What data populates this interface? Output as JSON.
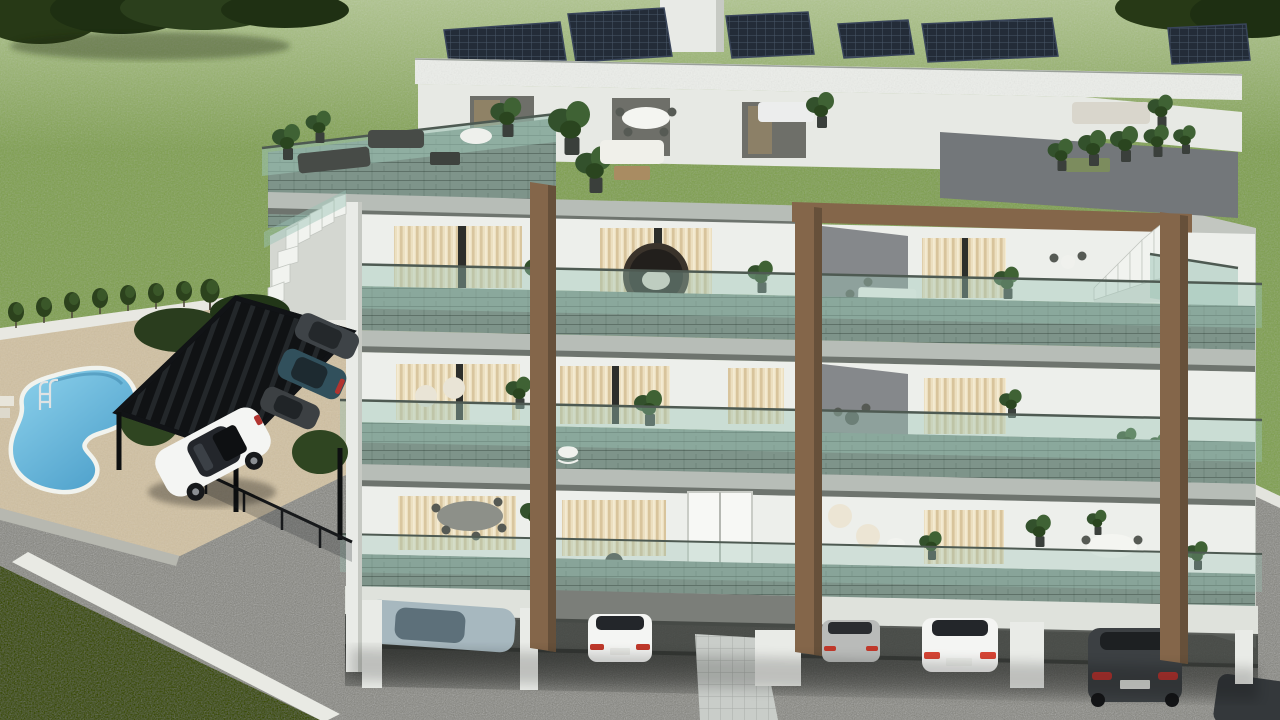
{
  "scene": {
    "type": "3D architectural exterior rendering, aerial view",
    "subject": "Modern terraced apartment residence at dusk with warm interior lighting",
    "labels": {
      "lawn": "large green lawn surrounding the property",
      "trees_left": "tree cluster top left",
      "trees_right": "tree cluster top right",
      "gravel": "gray gravel driveway and parking court",
      "pool_area": "paved pool deck with planting along white garden wall",
      "pool": "freeform kidney-shaped swimming pool",
      "pool_ladder": "chrome pool ladder",
      "pergola": "black slatted pergola carport",
      "carport_cars": "cars parked under pergola carport",
      "white_car": "white car parked on gravel court",
      "building": "four-level modern apartment building",
      "roof_solar": "rooftop solar panel arrays",
      "roof_terrace": "roof terrace with outdoor lounge furniture and planters",
      "floor2_balcony": "second floor balconies with glass balustrade",
      "floor1_balcony": "first floor balconies with glass balustrade",
      "ground_terrace": "ground floor terraces",
      "parking_level": "open parking level under the building",
      "stairs_left": "external staircase on left side",
      "stairs_right": "external staircase to roof terrace on right side",
      "walkway": "tiled walkway from parking court",
      "curb": "white curb between gravel court and lawn",
      "fence": "dark framed glass fence by pool deck"
    }
  },
  "palette": {
    "grass_base": "#87a55c",
    "grass_light_top": "#b2c68c",
    "grass_dark_corner": "#42511f",
    "tree_foliage": "#273916",
    "gravel_base": "#989893",
    "gravel_dark": "#6d6d68",
    "pool_deck": "#d3c4a7",
    "pool_water_light": "#8ed2ec",
    "pool_water_deep": "#4c9fca",
    "pool_rim": "#f1f3ee",
    "pergola_black": "#111316",
    "bronze_column": "#84664a",
    "bronze_shadow": "#66503a",
    "wall_white": "#edefeb",
    "wall_gray": "#85888b",
    "wall_gray_dark": "#73777a",
    "fascia_stone": "#b7bdb7",
    "soffit_dark": "#6e746e",
    "glass_green": "#9cc3b5",
    "paver_surface": "#7e948a",
    "curtain_cream": "#ecdfc0",
    "curtain_glow": "#f6e6bb",
    "interior_dark": "#6e6f69",
    "solar_panel": "#232c38",
    "car_white": "#f4f5f3",
    "car_teal": "#31505c",
    "car_charcoal": "#3c4043",
    "car_silver": "#b9bbb9",
    "car_steel_blue_roof": "#a7b8bf",
    "walkway_tile": "#c9cdc9",
    "curb_white": "#e9eae4"
  },
  "building": {
    "storeys_visible": 4,
    "solar_panel_arrays": 6,
    "facade_accents": "bronze-brown structural frame columns",
    "balustrades": "green-tinted glass",
    "exterior_stairs": [
      "left descending staircase",
      "right staircase to roof terrace"
    ],
    "rooftop_furniture": [
      "dark lounge sofas",
      "white dining table with chairs",
      "white lounge sofa",
      "wood coffee table",
      "planter boxes with greenery"
    ],
    "balcony_items": [
      "hanging egg chair",
      "white sofas",
      "cream armchairs",
      "dining sets",
      "bistro sets",
      "potted plants",
      "white scooter",
      "rocking horse toy"
    ],
    "lighting": "warm glow through cream curtains"
  },
  "site": {
    "pool": {
      "shape": "freeform kidney",
      "ladder": true,
      "deck": "beige pavers",
      "steps": true
    },
    "carport": {
      "style": "black slatted pergola",
      "vehicles_under": 3
    },
    "ground_parking_vehicles": 6,
    "driveway_surface": "gray gravel",
    "walkway": "light tiled path",
    "lawn_walls": [
      "white garden wall with shrub row above pool deck",
      "low white wall at right lawn edge"
    ]
  },
  "vehicles": [
    {
      "color": "white",
      "location": "gravel court"
    },
    {
      "color": "dark teal",
      "location": "pergola carport"
    },
    {
      "color": "dark gray",
      "location": "pergola carport"
    },
    {
      "color": "charcoal",
      "location": "pergola carport"
    },
    {
      "color": "steel blue",
      "location": "under building"
    },
    {
      "color": "white",
      "location": "under building"
    },
    {
      "color": "silver",
      "location": "under building"
    },
    {
      "color": "white",
      "location": "under building"
    },
    {
      "color": "charcoal",
      "location": "under building"
    },
    {
      "color": "charcoal",
      "location": "bottom right corner"
    }
  ]
}
